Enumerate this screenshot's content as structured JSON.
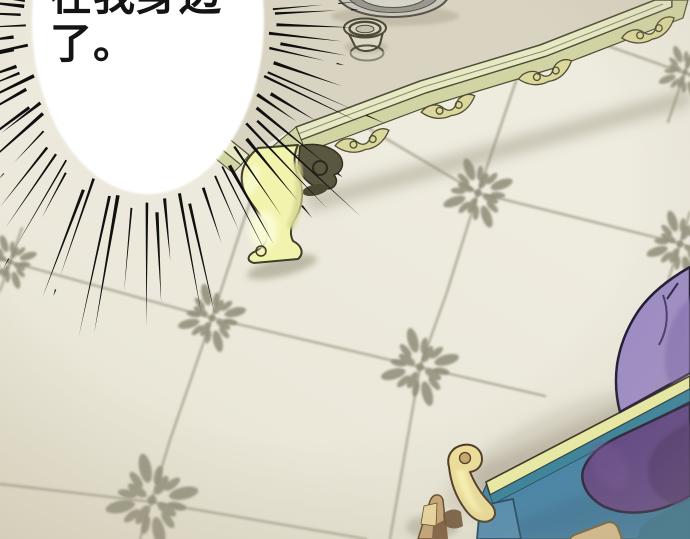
{
  "panel": {
    "type": "comic-panel",
    "speech_bubble": {
      "line1": "在我身边",
      "line2": "了。"
    }
  },
  "palette": {
    "ink": "#101010",
    "floor": "#ece9db",
    "floor_shadow": "#8f8971",
    "tile": "#a19e89",
    "flower": "#8e8b77",
    "table_top": "#d9d3c1",
    "molding_light": "#e7e8c4",
    "molding_mid": "#d3d4a4",
    "molding_dark": "#4e4d35",
    "carving": "#dcd79a",
    "leg": "#f2f3ad",
    "leg_hi": "#fbfcd6",
    "leg_shade": "#d8d996",
    "leg_stroke": "#3f3e29",
    "bracket": "#5a5640",
    "bracket_dark": "#4c4834",
    "plate_rim": "#c9c7bc",
    "plate_ring": "#999890",
    "plate_face": "#d7d4ca",
    "plate_center": "#b2afa4",
    "plate_stroke": "#54534a",
    "cup_body": "#ddd9c6",
    "cup_rim": "#d9d5c1",
    "cup_dark": "#4b4a37",
    "cup_center": "#c4c0ac",
    "trim": "#eef0a6",
    "trim_stroke": "#2f2f1d",
    "bench_blue": "#3a80a9",
    "bench_blue_light": "#4a8ab2",
    "bench_blue_dark": "#2c6691",
    "bench_teal": "#2f7f9b",
    "bench_teal_dark": "#2a6b8c",
    "gold": "#efe09a",
    "gold_hi": "#fdf6b4",
    "gold_dark": "#c8a86b",
    "gold_stroke": "#4a3623",
    "wood": "#c7a474",
    "wood_light": "#ecd9a0",
    "wood_dark": "#7c5c3c",
    "wood_stroke": "#5d4527",
    "knob": "#d9be8a",
    "knob_stroke": "#6e5a38",
    "purple_light": "#9d8bc6",
    "purple_light_shade": "#8a76b8",
    "purple_dark": "#583c82",
    "purple_deep": "#482e6c",
    "purple_stroke": "#1c1530",
    "white": "#ffffff"
  },
  "floor": {
    "flowers": [
      {
        "x": 10,
        "y": 262,
        "r": -18,
        "s": 0.8
      },
      {
        "x": 212,
        "y": 318,
        "r": -14,
        "s": 1
      },
      {
        "x": 478,
        "y": 193,
        "r": -20,
        "s": 1.05
      },
      {
        "x": 152,
        "y": 500,
        "r": -12,
        "s": 1.35
      },
      {
        "x": 685,
        "y": 72,
        "r": -22,
        "s": 0.8
      },
      {
        "x": 420,
        "y": 367,
        "r": -15,
        "s": 1.15
      },
      {
        "x": 680,
        "y": 244,
        "r": -18,
        "s": 1
      }
    ],
    "lines": [
      [
        [
          0,
          259
        ],
        [
          212,
          318
        ],
        [
          420,
          367
        ],
        [
          545,
          396
        ]
      ],
      [
        [
          368,
          128
        ],
        [
          478,
          193
        ],
        [
          678,
          243
        ],
        [
          690,
          247
        ]
      ],
      [
        [
          574,
          34
        ],
        [
          690,
          75
        ]
      ],
      [
        [
          0,
          484
        ],
        [
          152,
          502
        ],
        [
          366,
          539
        ]
      ],
      [
        [
          268,
          148
        ],
        [
          240,
          232
        ],
        [
          212,
          318
        ],
        [
          170,
          440
        ],
        [
          140,
          539
        ]
      ],
      [
        [
          517,
          78
        ],
        [
          478,
          193
        ],
        [
          446,
          295
        ],
        [
          420,
          367
        ],
        [
          390,
          539
        ]
      ],
      [
        [
          22,
          228
        ],
        [
          10,
          262
        ],
        [
          0,
          291
        ]
      ],
      [
        [
          690,
          56
        ],
        [
          685,
          72
        ],
        [
          668,
          122
        ]
      ],
      [
        [
          690,
          212
        ],
        [
          680,
          244
        ],
        [
          658,
          312
        ]
      ]
    ]
  },
  "speed_lines": {
    "cx": 148,
    "cy": 20,
    "rx": 116,
    "ry": 174,
    "count": 88,
    "seed": 11,
    "color": "#101010",
    "gap_min": 4,
    "gap_var": 16,
    "len_min": 38,
    "len_var": 92
  }
}
